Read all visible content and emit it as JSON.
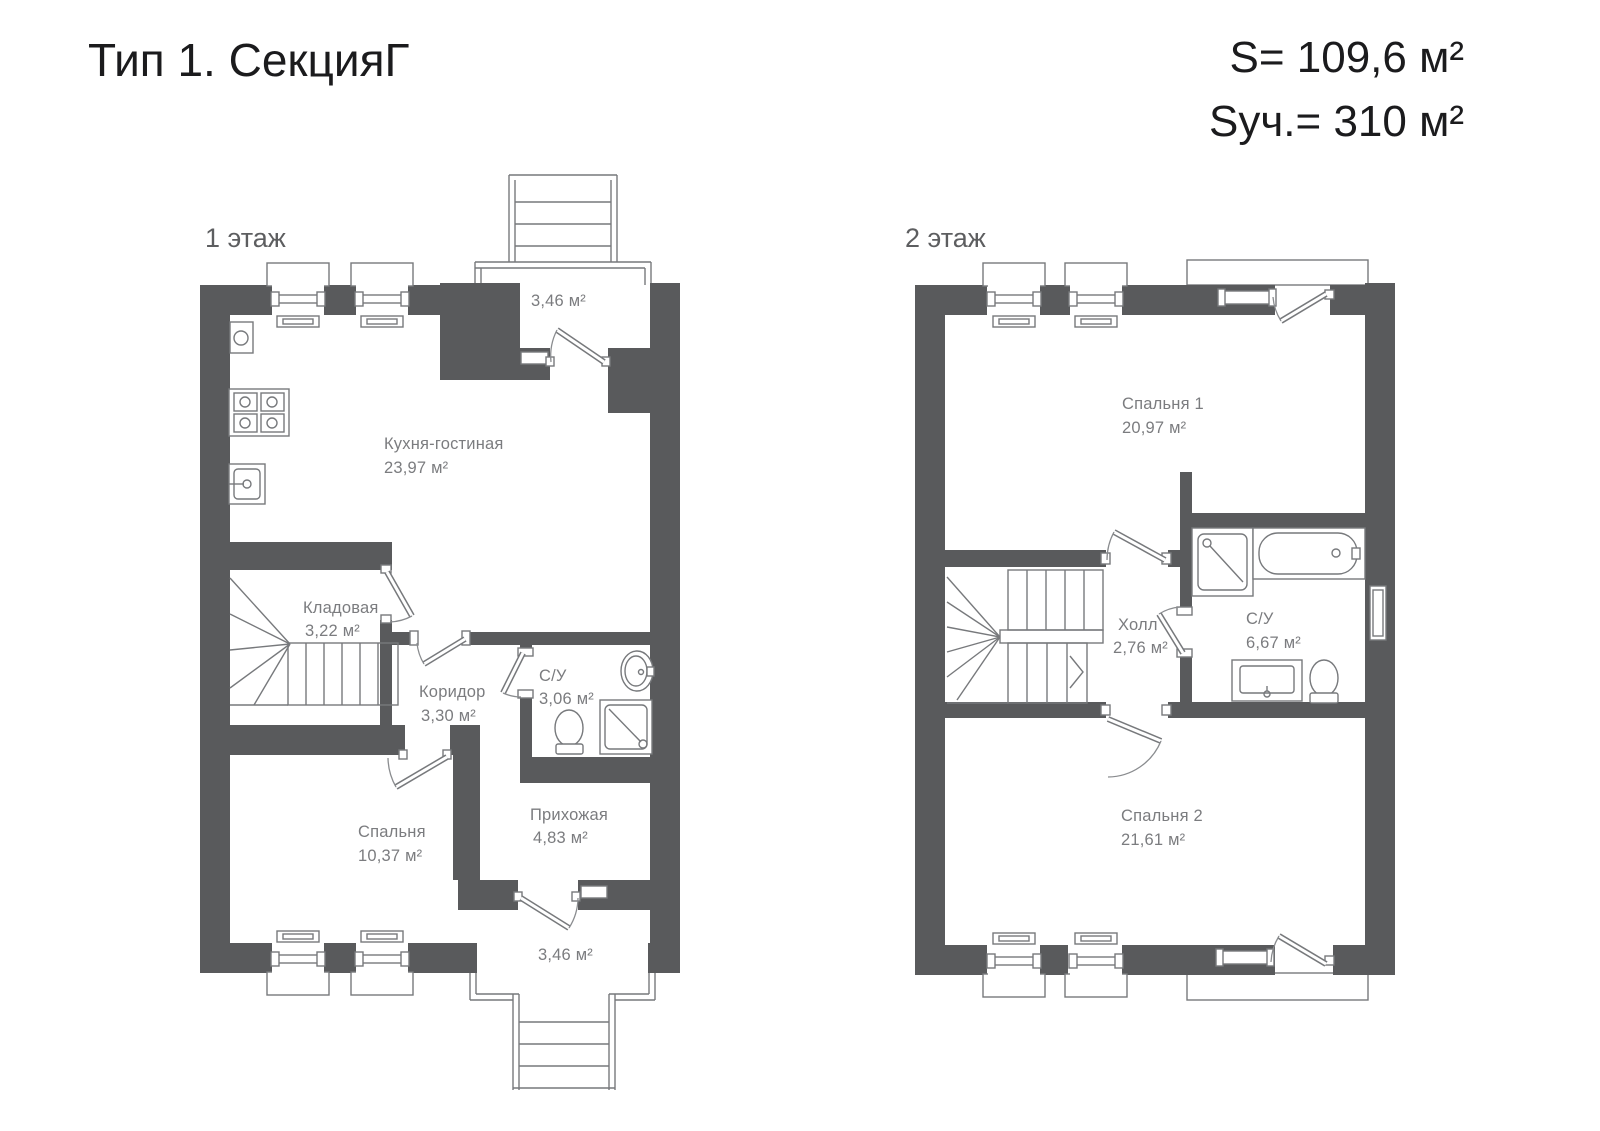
{
  "header": {
    "title": "Тип 1. СекцияГ",
    "area_total": "S= 109,6 м²",
    "area_plot": "Sуч.= 310 м²"
  },
  "floor1": {
    "label": "1 этаж",
    "rooms": {
      "kitchen": {
        "name": "Кухня-гостиная",
        "area": "23,97 м²"
      },
      "storage": {
        "name": "Кладовая",
        "area": "3,22 м²"
      },
      "corridor": {
        "name": "Коридор",
        "area": "3,30 м²"
      },
      "bathroom": {
        "name": "С/У",
        "area": "3,06 м²"
      },
      "hallway": {
        "name": "Прихожая",
        "area": "4,83 м²"
      },
      "bedroom": {
        "name": "Спальня",
        "area": "10,37 м²"
      },
      "porch_top": {
        "area": "3,46 м²"
      },
      "porch_bottom": {
        "area": "3,46 м²"
      }
    }
  },
  "floor2": {
    "label": "2 этаж",
    "rooms": {
      "bedroom1": {
        "name": "Спальня 1",
        "area": "20,97 м²"
      },
      "hall": {
        "name": "Холл",
        "area": "2,76 м²"
      },
      "bathroom": {
        "name": "С/У",
        "area": "6,67 м²"
      },
      "bedroom2": {
        "name": "Спальня 2",
        "area": "21,61 м²"
      }
    }
  },
  "colors": {
    "wall": "#595a5c",
    "line": "#77797c",
    "label": "#7b7c7f"
  }
}
